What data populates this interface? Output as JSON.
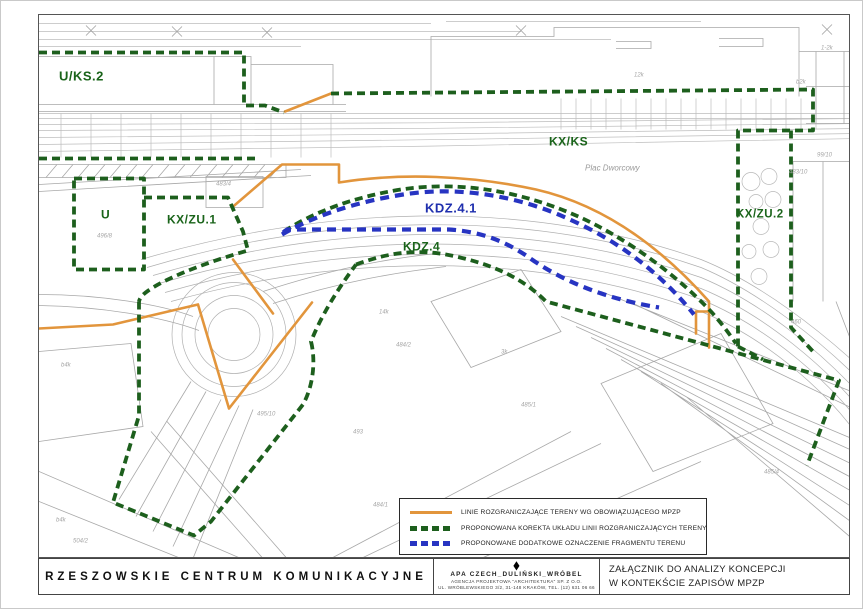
{
  "map": {
    "region_labels": [
      "U/KS.2",
      "U",
      "KX/ZU.1",
      "KX/KS",
      "KDZ.4.1",
      "KDZ.4",
      "KX/ZU.2"
    ],
    "place_label": "Plac Dworcowy",
    "parcel_labels": [
      "483/4",
      "496/8",
      "12k",
      "b2k",
      "1-2k",
      "99/10",
      "483/10",
      "484/2",
      "14k",
      "484/1",
      "493",
      "495/10",
      "504/2",
      "494/1",
      "b4k",
      "b4k",
      "485/1",
      "485/4",
      "3k",
      "460"
    ],
    "colors": {
      "existing_mpzp_line": "#e2953c",
      "proposed_correction_line": "#1d5f1d",
      "proposed_additional_line": "#2734c2",
      "base_linework": "#b5b5b5"
    }
  },
  "legend": {
    "items": [
      {
        "swatch": "orange-solid-line",
        "label": "LINIE ROZGRANICZAJĄCE TERENY WG OBOWIĄZUJĄCEGO MPZP"
      },
      {
        "swatch": "green-dashed-line",
        "label": "PROPONOWANA KOREKTA UKŁADU LINII ROZGRANICZAJĄCYCH TERENY"
      },
      {
        "swatch": "blue-dashed-line",
        "label": "PROPONOWANE DODATKOWE OZNACZENIE FRAGMENTU TERENU"
      }
    ]
  },
  "titleblock": {
    "project_title": "RZESZOWSKIE CENTRUM KOMUNIKACYJNE",
    "firm_logo": "◆",
    "firm_name": "APA CZECH_DULIŃSKI_WRÓBEL",
    "firm_line2": "AGENCJA PROJEKTOWA \"ARCHITEKTURA\" SP. Z O.O.",
    "firm_line3": "UL. WRÓBLEWSKIEGO 3/2, 31-148 KRAKÓW, TEL. (12) 631 06 66",
    "attachment_line1": "ZAŁĄCZNIK DO ANALIZY KONCEPCJI",
    "attachment_line2": "W KONTEKŚCIE ZAPISÓW MPZP"
  }
}
